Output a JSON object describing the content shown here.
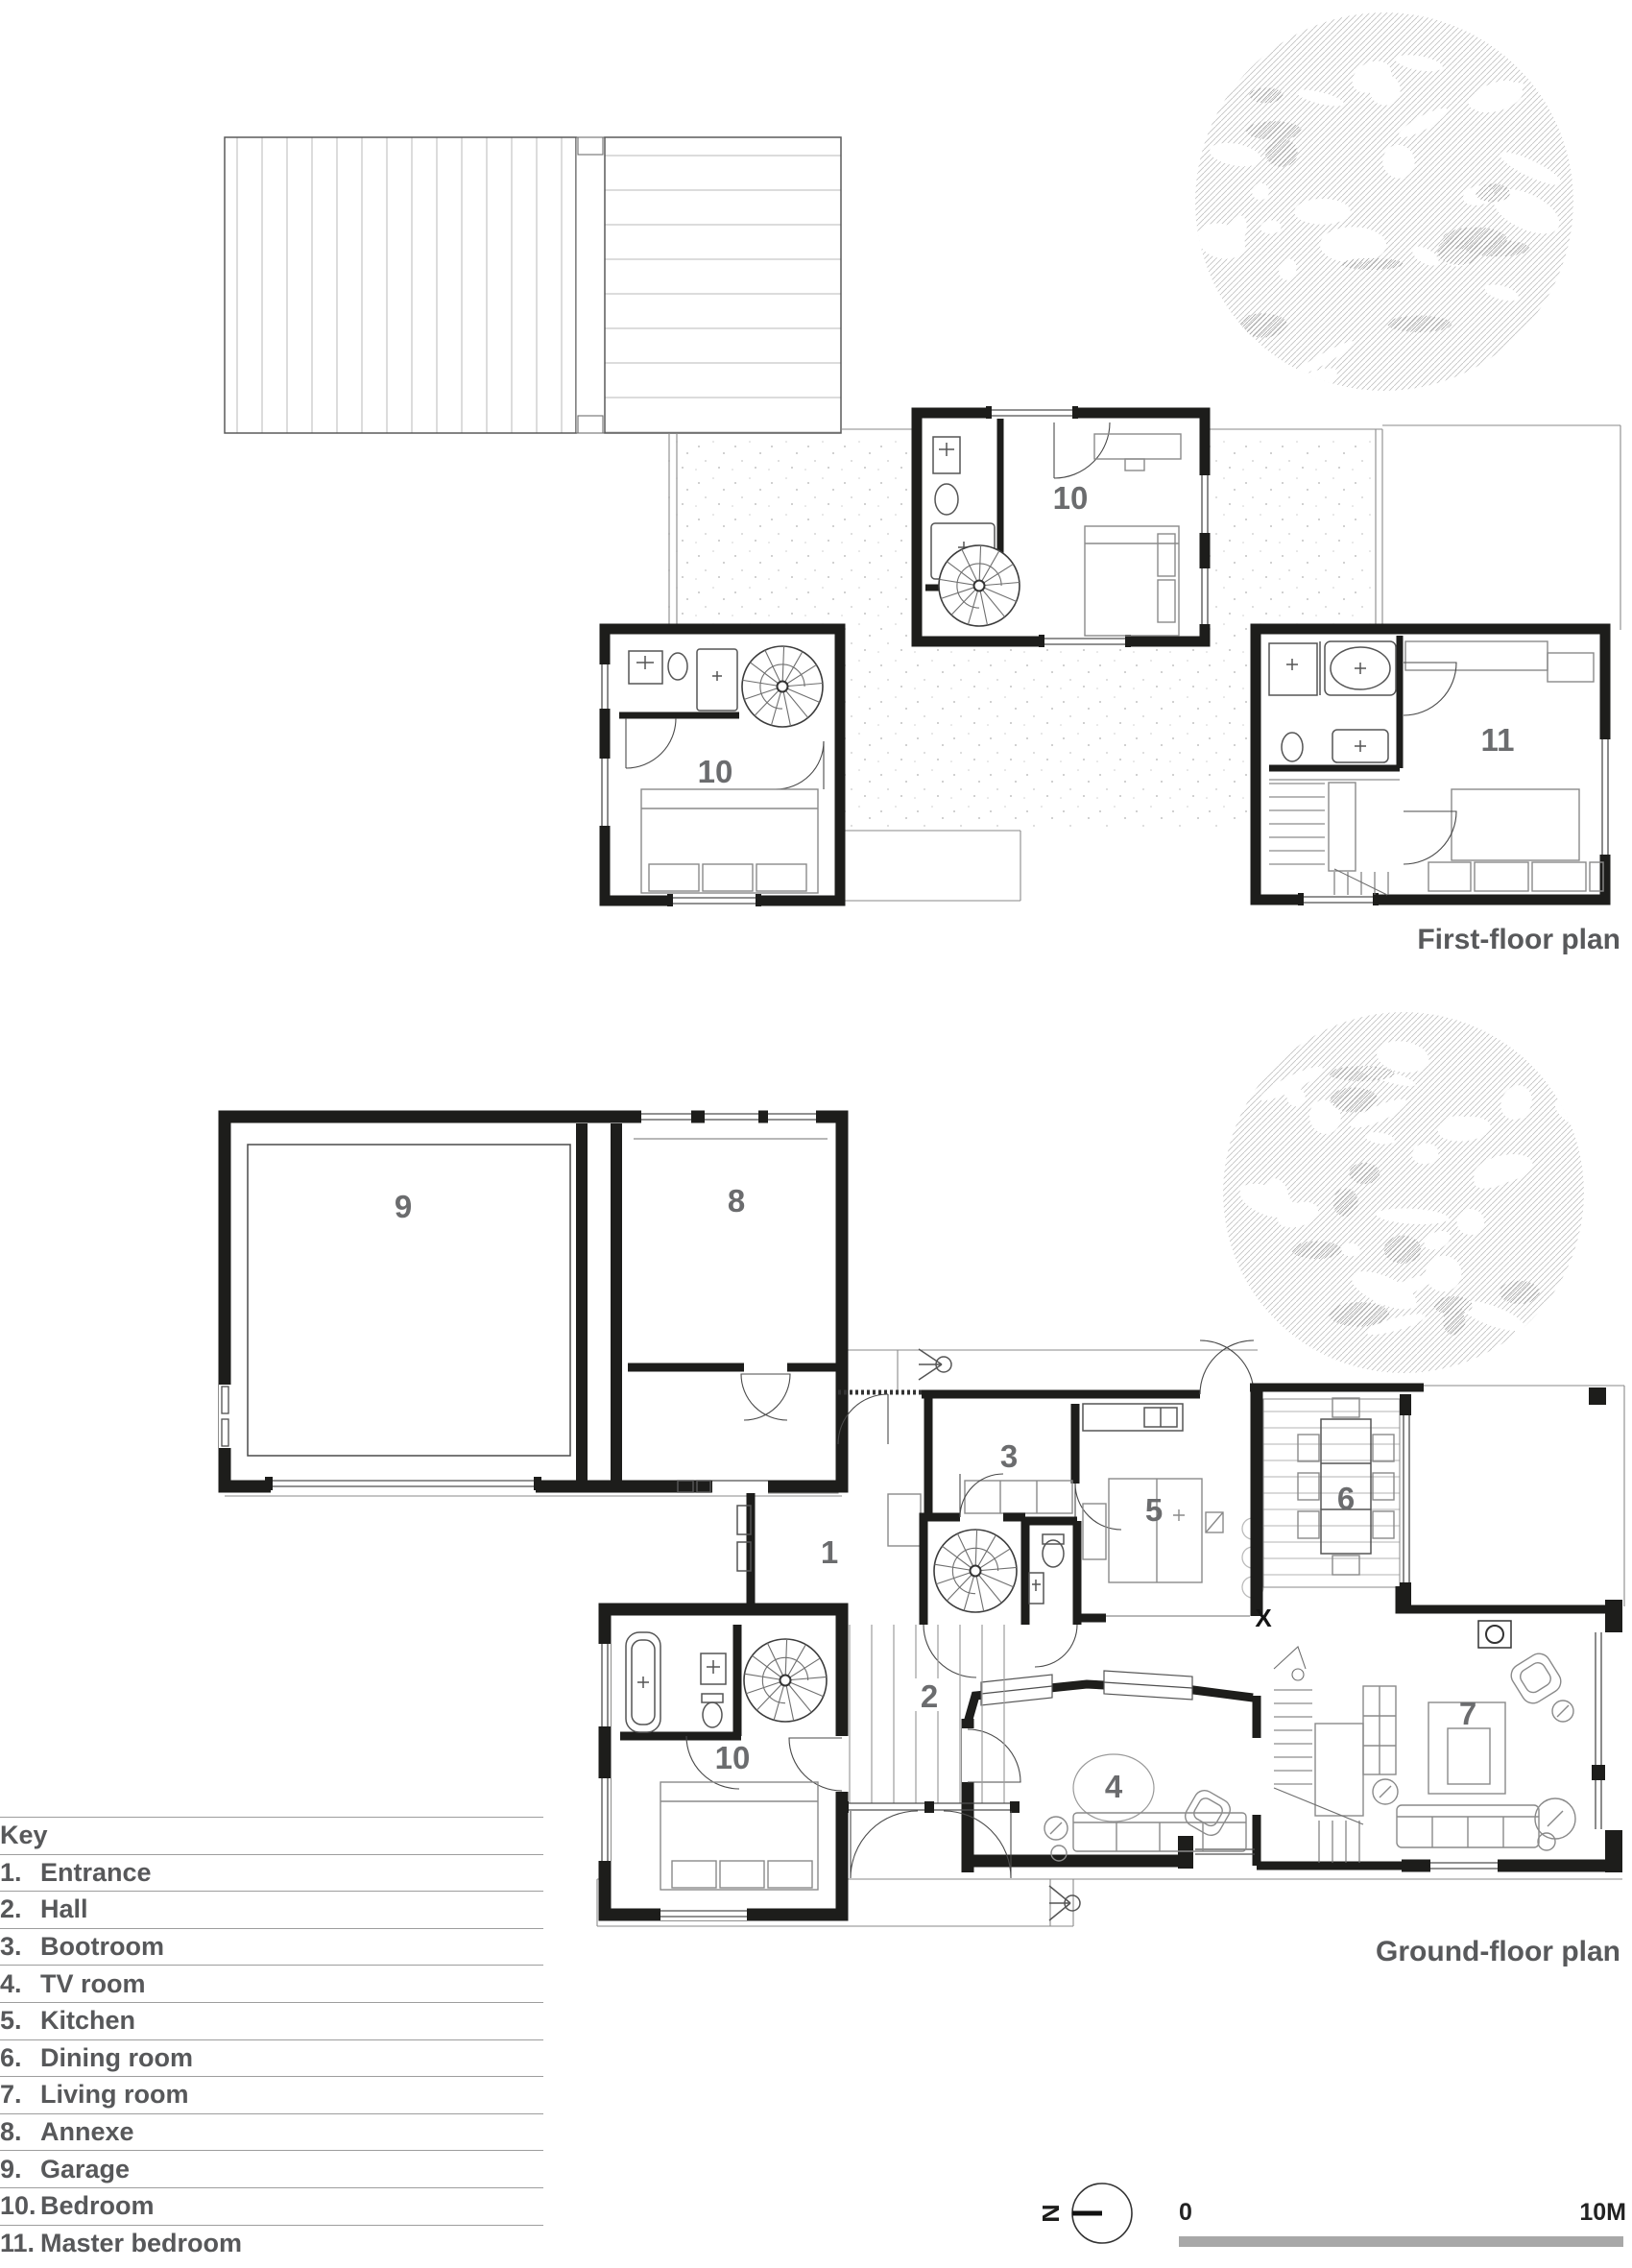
{
  "sheet": {
    "type": "architectural floor plans"
  },
  "first_floor": {
    "title": "First-floor plan",
    "labels": {
      "bedroom_center": "10",
      "bedroom_left": "10",
      "master_bedroom": "11"
    }
  },
  "ground_floor": {
    "title": "Ground-floor plan",
    "labels": {
      "entrance": "1",
      "hall": "2",
      "bootroom": "3",
      "tv_room": "4",
      "kitchen": "5",
      "dining_room": "6",
      "living_room": "7",
      "annexe": "8",
      "garage": "9",
      "bedroom": "10"
    },
    "section_marker": "X"
  },
  "key": {
    "title": "Key",
    "items": [
      {
        "number": "1.",
        "label": "Entrance"
      },
      {
        "number": "2.",
        "label": "Hall"
      },
      {
        "number": "3.",
        "label": "Bootroom"
      },
      {
        "number": "4.",
        "label": "TV room"
      },
      {
        "number": "5.",
        "label": "Kitchen"
      },
      {
        "number": "6.",
        "label": "Dining room"
      },
      {
        "number": "7.",
        "label": "Living room"
      },
      {
        "number": "8.",
        "label": "Annexe"
      },
      {
        "number": "9.",
        "label": "Garage"
      },
      {
        "number": "10.",
        "label": "Bedroom"
      },
      {
        "number": "11.",
        "label": "Master bedroom"
      }
    ]
  },
  "north_indicator": {
    "label": "N"
  },
  "scale_bar": {
    "start_label": "0",
    "end_label": "10M"
  },
  "colors": {
    "wall": "#1d1d1b",
    "label_text": "#6b6c6e",
    "title_text": "#58595b",
    "scale_bar": "#a8a8a8",
    "hatch": "#c3c3c3",
    "boards": "#b0b0b0"
  }
}
